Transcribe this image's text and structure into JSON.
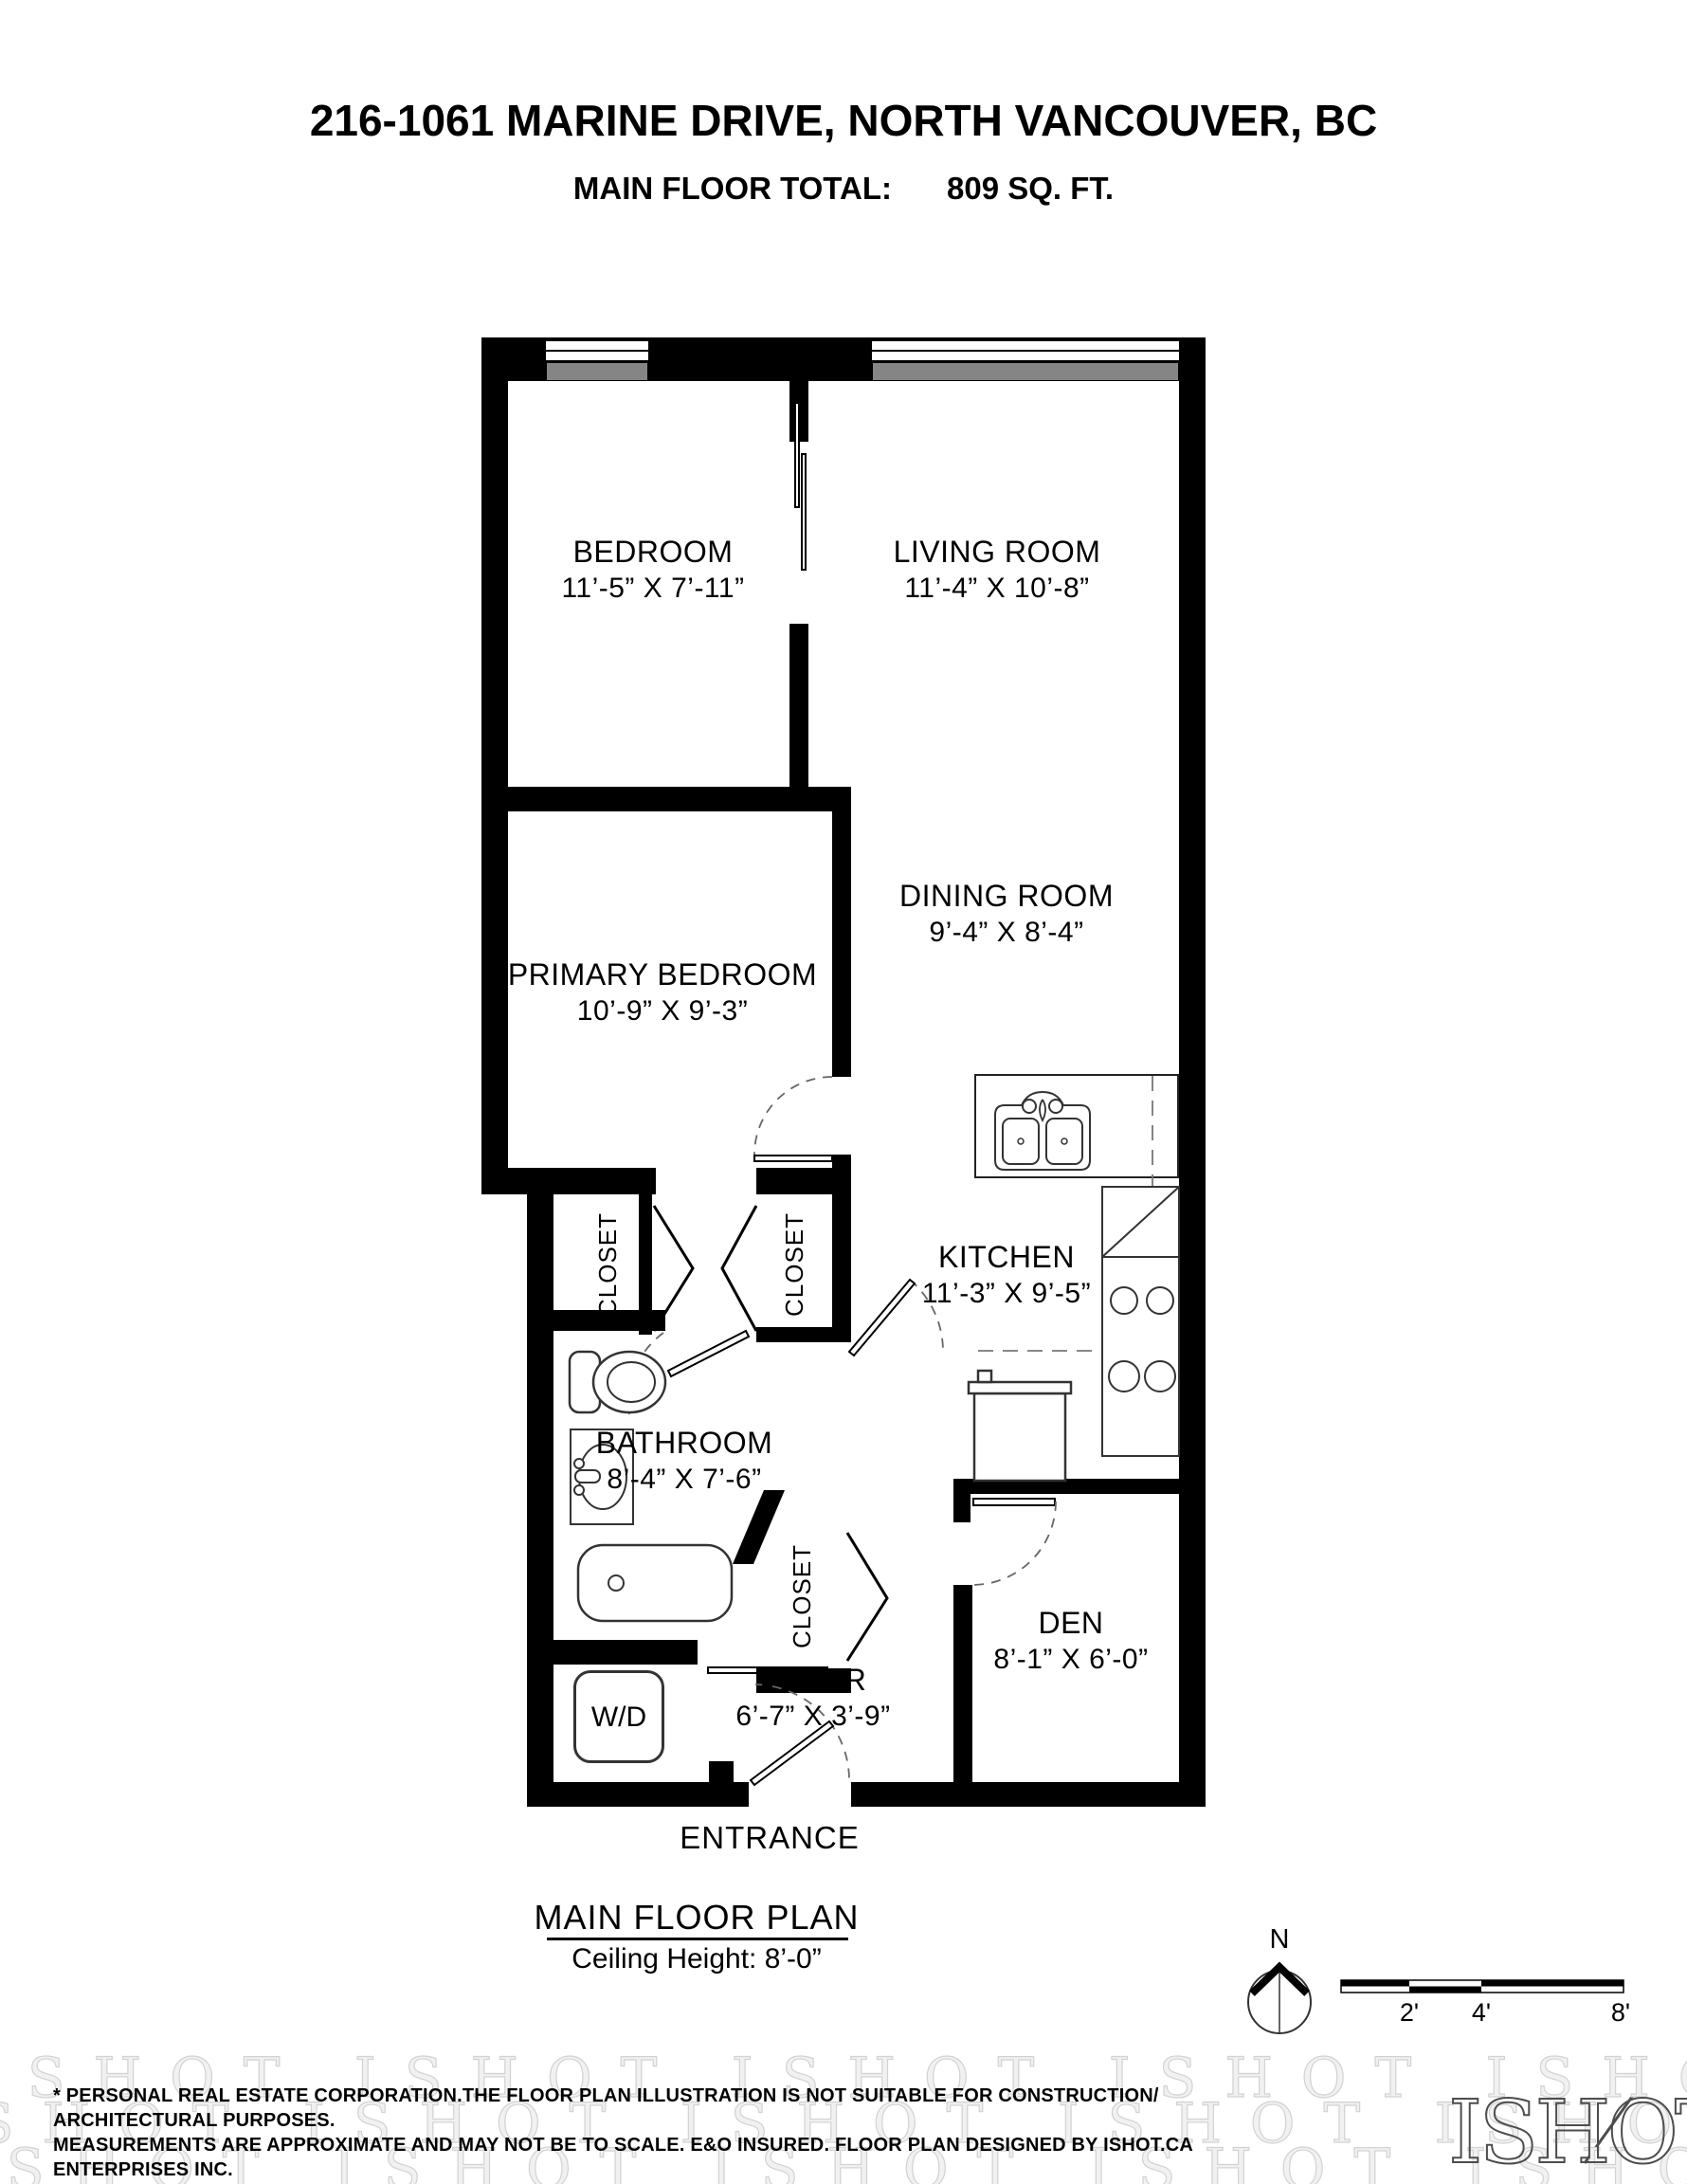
{
  "header": {
    "title": "216-1061 MARINE DRIVE, NORTH VANCOUVER, BC",
    "total_label": "MAIN FLOOR TOTAL:",
    "total_value": "809 SQ. FT."
  },
  "plan": {
    "rooms": [
      {
        "name": "BEDROOM",
        "dims": "11’-5” X 7’-11”"
      },
      {
        "name": "LIVING ROOM",
        "dims": "11’-4” X 10’-8”"
      },
      {
        "name": "PRIMARY BEDROOM",
        "dims": "10’-9” X 9’-3”"
      },
      {
        "name": "DINING ROOM",
        "dims": "9’-4” X 8’-4”"
      },
      {
        "name": "KITCHEN",
        "dims": "11’-3” X 9’-5”"
      },
      {
        "name": "BATHROOM",
        "dims": "8’-4” X 7’-6”"
      },
      {
        "name": "DEN",
        "dims": "8’-1” X 6’-0”"
      },
      {
        "name": "FOYER",
        "dims": "6’-7” X 3’-9”"
      }
    ],
    "closet_label": "CLOSET",
    "washer_dryer_label": "W/D",
    "entrance_label": "ENTRANCE"
  },
  "plan_footer": {
    "plan_title": "MAIN FLOOR PLAN",
    "ceiling_height": "Ceiling Height: 8’-0”",
    "north_label": "N",
    "scale_ticks": [
      "2'",
      "4'",
      "8'"
    ]
  },
  "disclaimer": {
    "line1": "* PERSONAL REAL ESTATE CORPORATION.THE FLOOR PLAN ILLUSTRATION IS NOT SUITABLE FOR CONSTRUCTION/ ARCHITECTURAL PURPOSES.",
    "line2": "MEASUREMENTS ARE APPROXIMATE AND MAY NOT BE TO SCALE. E&O INSURED. FLOOR PLAN DESIGNED BY ISHOT.CA ENTERPRISES INC.",
    "line3": "604-368-7979  ISHOT.CA"
  },
  "branding": {
    "logo_text": "ISHOT",
    "watermark_text": "ISHOT"
  },
  "colors": {
    "wall": "#000000",
    "window_sill": "#858585",
    "watermark": "#d2d2d2",
    "dashed_door": "#666666"
  }
}
